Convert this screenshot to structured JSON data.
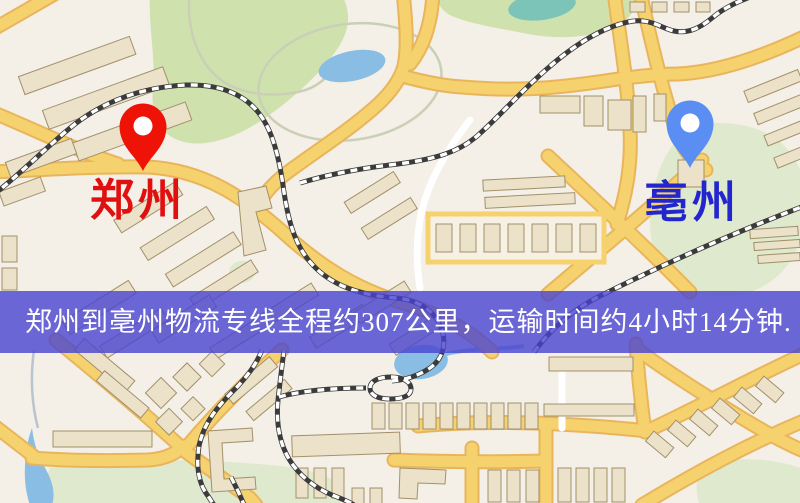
{
  "window": {
    "width": 800,
    "height": 503
  },
  "map": {
    "background_color": "#f4efe7",
    "road_color": "#f6d26f",
    "road_casing_color": "#e9b55b",
    "park_color": "#cfe2ad",
    "park_pale_color": "#dfe9cd",
    "water_color": "#8abde4",
    "pond_color": "#7cc4b8",
    "building_fill": "#ebe2c9",
    "building_stroke": "#a2906a",
    "railway_dark": "#3b3b3b",
    "railway_light": "#ffffff"
  },
  "markers": {
    "origin": {
      "label": "郑州",
      "pin_color": "#ee1207",
      "label_color": "#e01010"
    },
    "destination": {
      "label": "亳州",
      "pin_color": "#5a8ef2",
      "label_color": "#2326cc"
    }
  },
  "banner": {
    "text": "郑州到亳州物流专线全程约307公里，运输时间约4小时14分钟.",
    "background_color": "rgba(72,68,210,0.8)",
    "text_color": "#ffffff"
  }
}
